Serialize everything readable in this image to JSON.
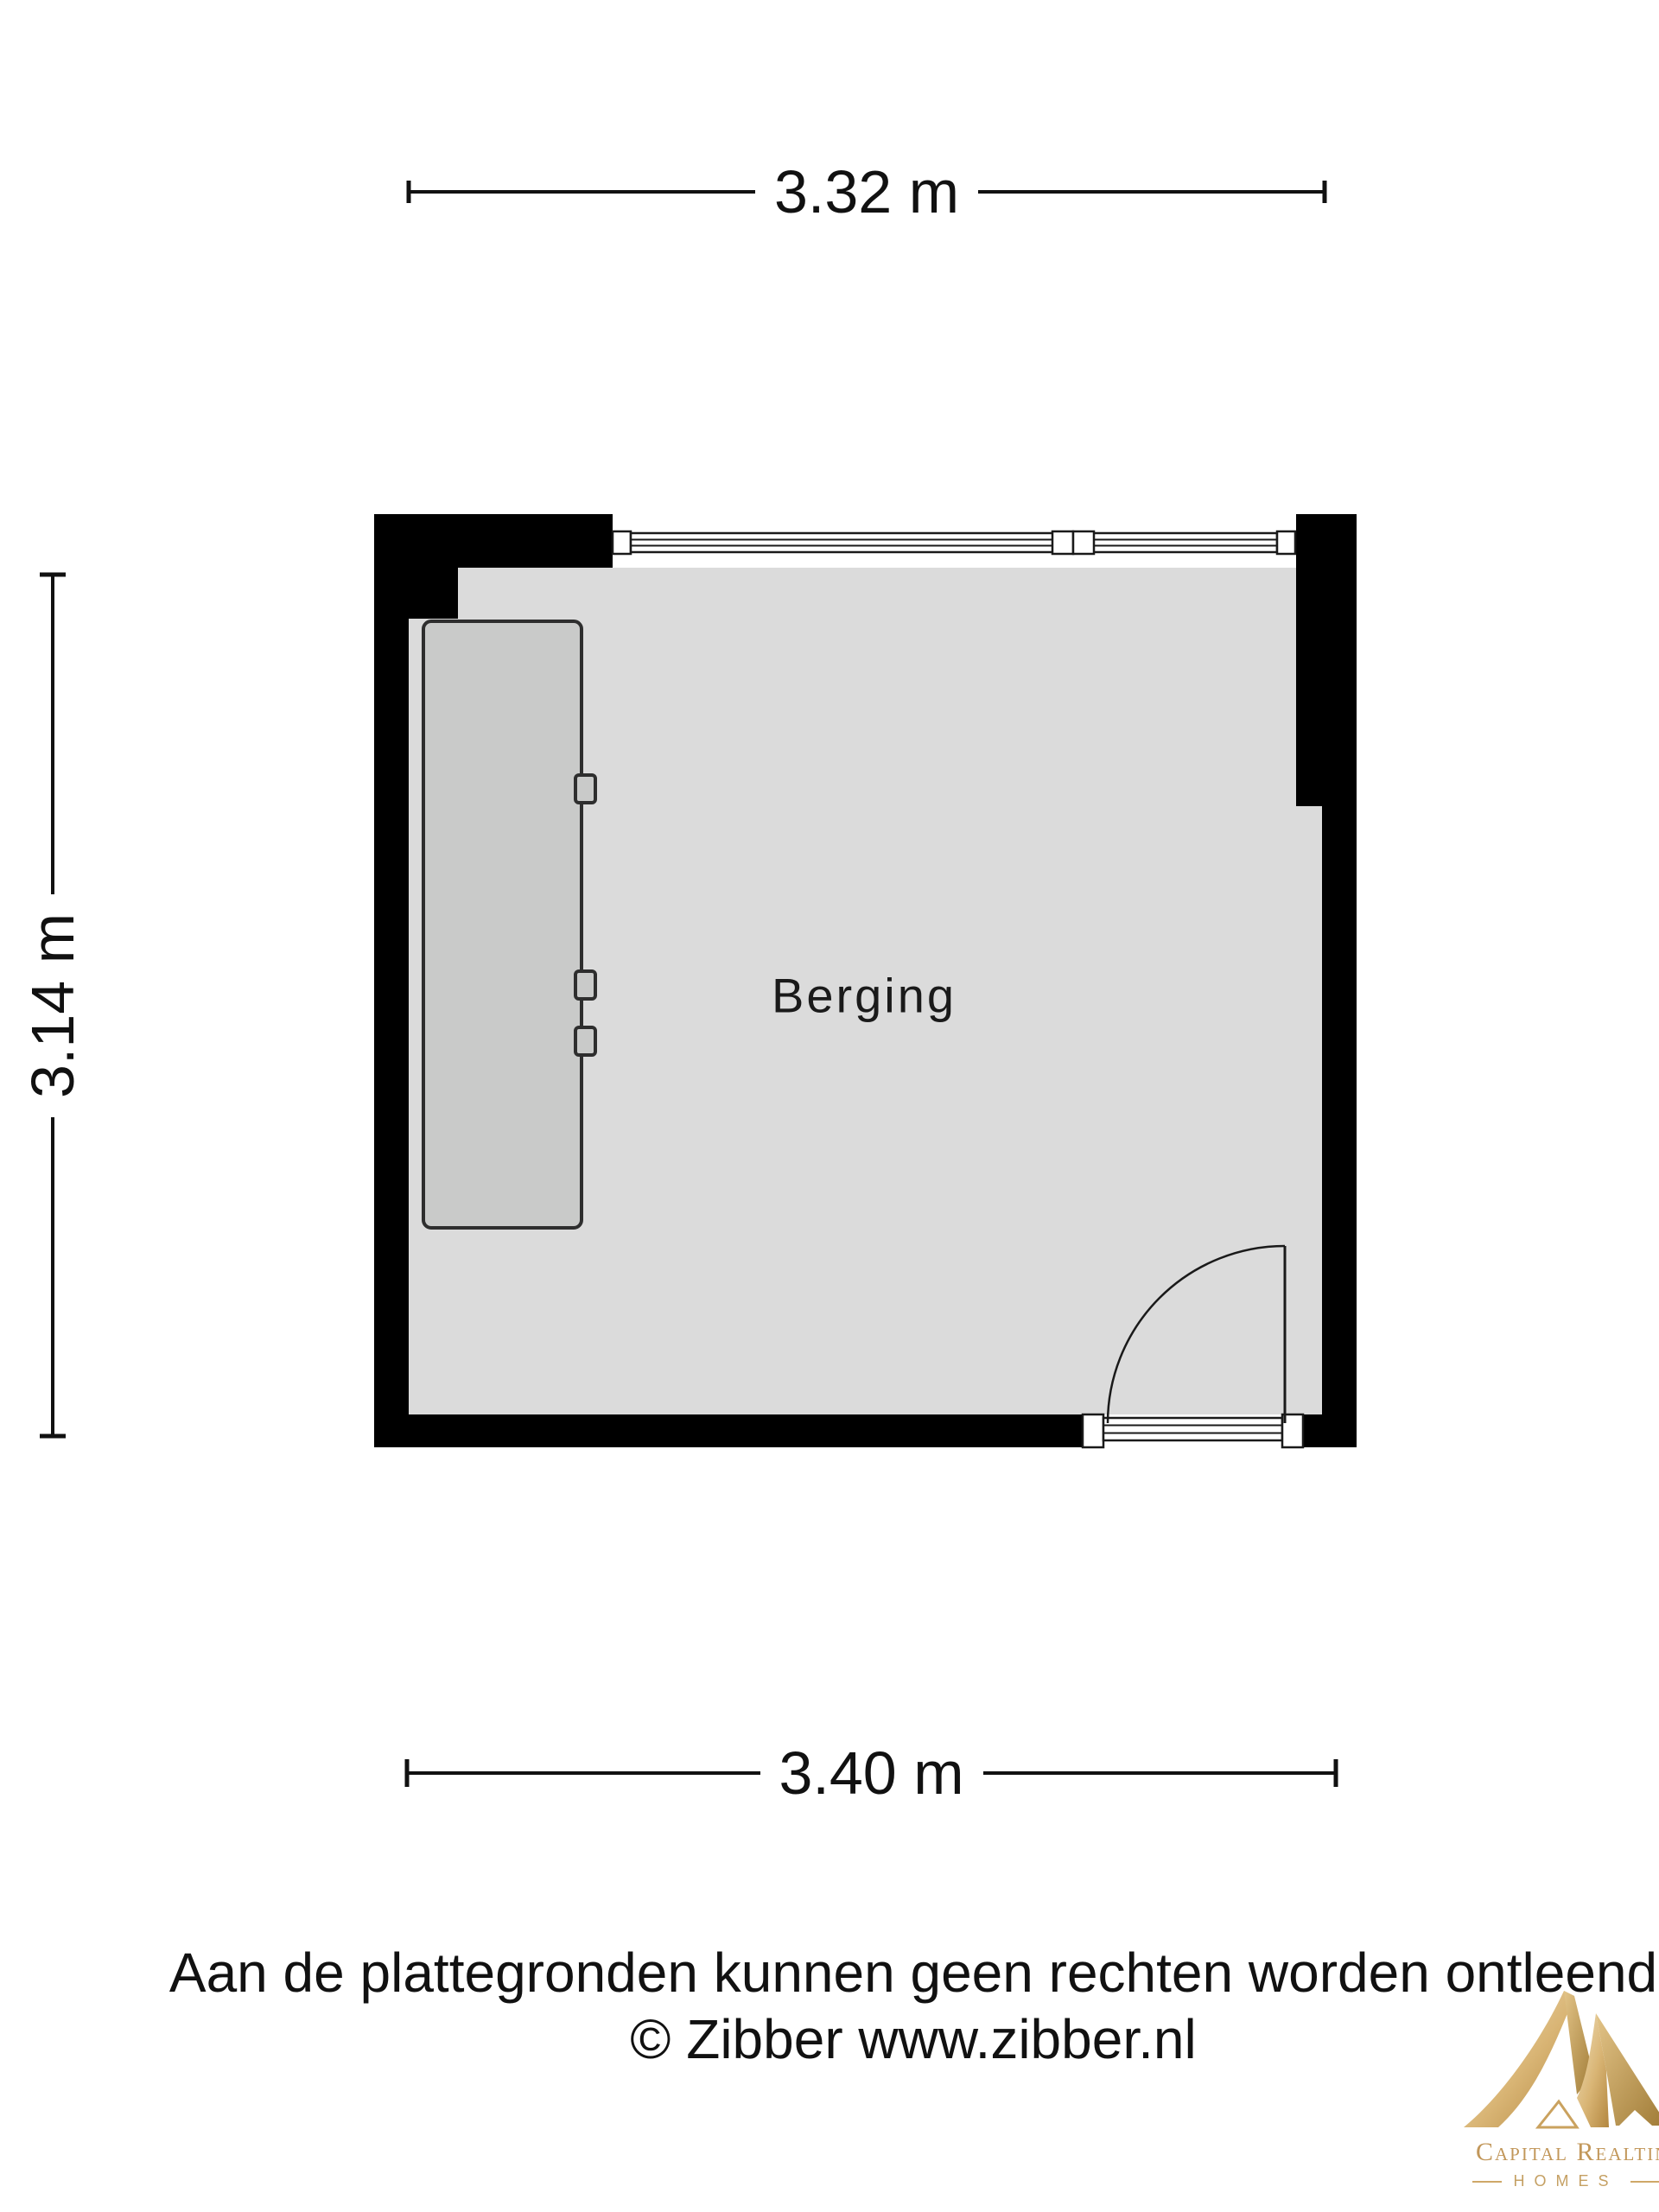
{
  "plan": {
    "room_label": "Berging",
    "dimensions": {
      "top": "3.32 m",
      "left": "3.14 m",
      "bottom": "3.40 m"
    },
    "colors": {
      "wall": "#000000",
      "floor": "#dbdbdb",
      "furniture_fill": "#c9cac9",
      "outline": "#1a1a1a"
    }
  },
  "footer": {
    "disclaimer": "Aan de plattegronden kunnen geen rechten worden ontleend",
    "copyright": "© Zibber www.zibber.nl"
  },
  "logo": {
    "brand": "Capital Realtin",
    "tagline": "HOMES",
    "gold": "#c2975a"
  }
}
